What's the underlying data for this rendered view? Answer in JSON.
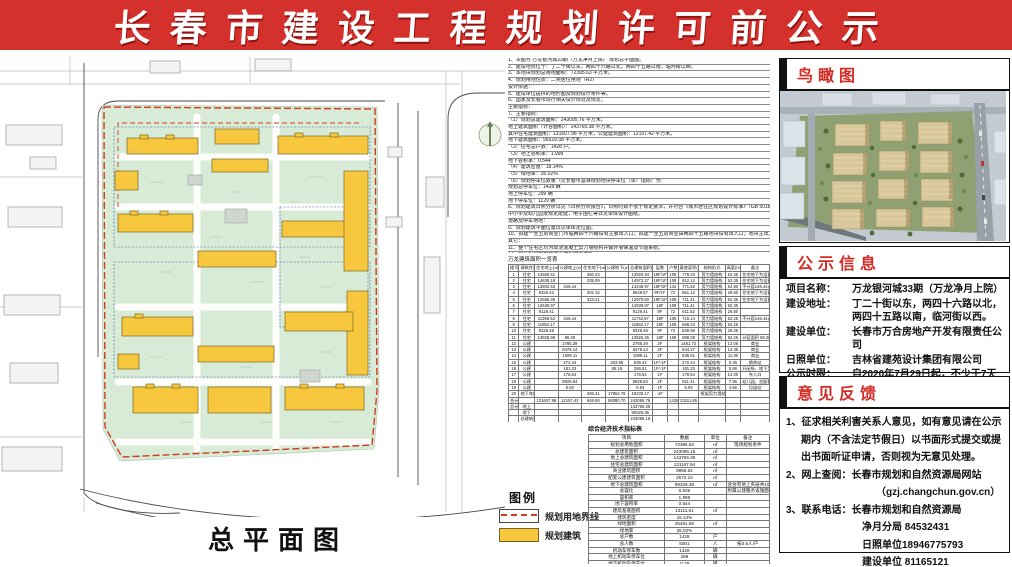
{
  "banner": {
    "title": "长春市建设工程规划许可前公示"
  },
  "site_plan": {
    "title": "总平面图",
    "legend": {
      "title": "图例",
      "items": [
        {
          "label": "规划用地界线",
          "swatch": "red-dashed-line"
        },
        {
          "label": "规划建筑",
          "swatch": "yellow-fill"
        }
      ]
    }
  },
  "notes": {
    "lines": [
      "1、本图为 万龙银河城33期（万龙净月上院） 规划总平面图。",
      "2、建设地点位于：丁二十街以东，两四十六路以北，两四十五路以南，临河街以西。",
      "3、本地块规划总用地面积：72395.63 平方米。",
      "4、规划用地性质：二类居住用地（R2）",
      "设计依据：",
      "5、建设单位提供的地形图及规划设计条件等。",
      "6、国家及长春市现行相关设计规范及规定。",
      "主要指标：",
      "7、主要指标：",
      "（1）规划总建筑面积：243095.76 平方米。",
      "地上建筑面积（计容面积）：143765.38 平方米。",
      "其中住宅建筑面积：131607.98 平方米，公建建筑面积：12157.42 平方米。",
      "地下建筑面积：99329.38 平方米。",
      "（2）住宅总户数：1428 户。",
      "（3）地上容积率：1.999",
      "地下容积率：0.544",
      "（4）建筑密度：18.14%",
      "（5）绿地率：35.02%",
      "（6）规划停车位数量（见长春市基准规划地块停车位（单）指标）为：",
      "规划总停车位：1428 辆",
      "地上停车位：299 辆",
      "地下停车位：1129 辆",
      "8、规划建筑日照分析详见《日照分析报告》，日照时数不低于规定要求，并符合《城市居住区规划设计标准》（GB 50180-2018）。",
      "中小学及幼儿园按规定配建，电子围栏等详见单体设计图纸。",
      "道路及停车场地：",
      "9、规划建筑平面位置详见单体定位图。",
      "10、拟建一至五层商业门市临两四十六路设有主要出入口；拟建一至五层商业由两四十五路地块设有出入口；地块主出入口临丁二十街设置。",
      "其它：",
      "11、整个住宅区均为现浇混凝土剪力墙结构并做外墙保温及节能系统。",
      "12、停车位应预留安装充电设施的条件。",
      "13、图中尺寸以毫米计，标高以米计，均为绝对标高。",
      "14、本项目各单体建筑间距、退线均满足规范要求。拟建高层与周边既有建筑日照间距满足《城市居住区规划设计标准》要求，不足部分已与相关利害关系人协商，日照分析详见报告，板式高层不大于13m，塔式高层不大于15m。",
      "15、西侧不满足退线要求的建筑已与相关权利人签订书面协议，见全套成果存档。",
      "16、其他未尽事宜按《工程建设标准强制性条文》及现行有关规范执行。"
    ]
  },
  "building_table": {
    "title": "万龙建筑面积一览表",
    "columns": [
      "楼号",
      "建筑性质",
      "住宅地上(㎡)",
      "公建地上(㎡)",
      "住宅地下(㎡)",
      "公建地下(㎡)",
      "总建筑面积(㎡)",
      "层数",
      "户数",
      "基底面积(㎡)",
      "结构形式",
      "高度(m)",
      "备注"
    ],
    "rows": [
      [
        "1",
        "住宅",
        "13560.51",
        "",
        "360.43",
        "",
        "13920.94",
        "18F/1F",
        "108",
        "778.33",
        "剪力墙结构",
        "52.35",
        "住宅地下为设备夹层"
      ],
      [
        "2",
        "住宅",
        "14638.18",
        "",
        "335.09",
        "",
        "14973.27",
        "18F/1F",
        "108",
        "812.12",
        "剪力墙结构",
        "52.35",
        "住宅地下为设备夹层"
      ],
      [
        "3",
        "住宅",
        "13902.53",
        "346.44",
        "",
        "",
        "14248.97",
        "18F/2F",
        "144",
        "771.52",
        "剪力墙结构",
        "54.90",
        "不计容146.44㎡"
      ],
      [
        "4",
        "住宅",
        "9326.42",
        "",
        "302.15",
        "",
        "9628.57",
        "9F/1F",
        "72",
        "861.12",
        "剪力墙结构",
        "28.60",
        "住宅地下为设备夹层"
      ],
      [
        "5",
        "住宅",
        "12656.39",
        "",
        "323.21",
        "",
        "12979.60",
        "18F/1F",
        "108",
        "711.41",
        "剪力墙结构",
        "52.35",
        "住宅地下为设备夹层"
      ],
      [
        "6",
        "住宅",
        "12639.97",
        "",
        "",
        "",
        "12639.97",
        "18F",
        "108",
        "711.41",
        "剪力墙结构",
        "52.35",
        ""
      ],
      [
        "7",
        "住宅",
        "9128.41",
        "",
        "",
        "",
        "9128.41",
        "9F",
        "72",
        "611.52",
        "剪力墙结构",
        "26.60",
        ""
      ],
      [
        "8",
        "住宅",
        "11396.53",
        "346.44",
        "",
        "",
        "11742.97",
        "18F",
        "108",
        "715.14",
        "剪力墙结构",
        "52.25",
        "不计容146.44㎡"
      ],
      [
        "9",
        "住宅",
        "11862.17",
        "",
        "",
        "",
        "11862.17",
        "18F",
        "108",
        "668.34",
        "剪力墙结构",
        "52.25",
        ""
      ],
      [
        "10",
        "住宅",
        "8328.49",
        "",
        "",
        "",
        "8328.49",
        "9F",
        "72",
        "628.98",
        "剪力墙结构",
        "26.25",
        ""
      ],
      [
        "11",
        "住宅",
        "13828.98",
        "96.28",
        "",
        "",
        "13925.26",
        "18F",
        "108",
        "888.08",
        "剪力墙结构",
        "52.25",
        "计容面积 96.28㎡"
      ],
      [
        "12",
        "公建",
        "",
        "2785.39",
        "",
        "",
        "2785.39",
        "2F",
        "",
        "1481.72",
        "框架结构",
        "13.06",
        "商业"
      ],
      [
        "13",
        "公建",
        "",
        "8478.14",
        "",
        "",
        "8478.14",
        "3F",
        "",
        "844.37",
        "框架结构",
        "13.35",
        "商业"
      ],
      [
        "14",
        "公建",
        "",
        "1089.11",
        "",
        "",
        "1089.11",
        "2F",
        "",
        "638.81",
        "框架结构",
        "11.36",
        "商业"
      ],
      [
        "15",
        "公建",
        "",
        "272.44",
        "",
        "263.98",
        "536.42",
        "1F/-1F",
        "",
        "272.44",
        "框架结构",
        "5.36",
        "换热站"
      ],
      [
        "16",
        "公建",
        "",
        "181.33",
        "",
        "85.18",
        "266.51",
        "1F/-1F",
        "",
        "181.33",
        "框架结构",
        "5.88",
        "开闭所，地下为设备用房"
      ],
      [
        "17",
        "公建",
        "",
        "178.54",
        "",
        "",
        "178.54",
        "1F",
        "",
        "178.54",
        "框架结构",
        "14.00",
        "东入口"
      ],
      [
        "18",
        "公建",
        "",
        "8928.84",
        "",
        "",
        "8928.84",
        "2F",
        "",
        "911.41",
        "框架结构",
        "7.95",
        "幼儿园，含配套用房994.04㎡"
      ],
      [
        "19",
        "公建",
        "",
        "5.93",
        "",
        "",
        "5.93",
        "1F",
        "",
        "5.93",
        "框架结构",
        "4.56",
        "垃圾站"
      ],
      [
        "20",
        "地下车库",
        "",
        "",
        "265.41",
        "17964.76",
        "18230.17",
        "-1F",
        "",
        "",
        "框架剪力墙结构",
        "",
        ""
      ],
      [
        "合计",
        "",
        "131607.98",
        "12157.42",
        "948.68",
        "98380.70",
        "243095.76",
        "",
        "1428",
        "23111.85",
        "",
        "",
        ""
      ],
      [
        "总计",
        "地上",
        "",
        "",
        "",
        "",
        "143765.38",
        "",
        "",
        "",
        "",
        "",
        ""
      ],
      [
        "",
        "地下",
        "",
        "",
        "",
        "",
        "99329.38",
        "",
        "",
        "",
        "",
        "",
        ""
      ],
      [
        "",
        "总建筑面积",
        "",
        "",
        "",
        "",
        "243095.16",
        "",
        "",
        "",
        "",
        "",
        ""
      ]
    ]
  },
  "indicator_table": {
    "title": "综合经济技术指标表",
    "columns": [
      "项目",
      "数据",
      "单位",
      "备注"
    ],
    "rows": [
      [
        "规划总用地面积",
        "72395.63",
        "㎡",
        "现场规划条件"
      ],
      [
        "总建筑面积",
        "243095.16",
        "㎡",
        ""
      ],
      [
        "地上总建筑面积",
        "143765.38",
        "㎡",
        ""
      ],
      [
        "住宅总建筑面积",
        "131167.94",
        "㎡",
        ""
      ],
      [
        "商业建筑面积",
        "9956.64",
        "㎡",
        ""
      ],
      [
        "配套公建建筑面积",
        "2572.10",
        "㎡",
        ""
      ],
      [
        "地下总建筑面积",
        "99329.38",
        "㎡",
        "含住宅地上夹层共1049.09㎡"
      ],
      [
        "总容比",
        "6.939",
        "",
        "附属公建服务设施面积占地上总建筑面积"
      ],
      [
        "容积率",
        "1.999",
        "",
        ""
      ],
      [
        "地下容积率",
        "0.544",
        "",
        ""
      ],
      [
        "建筑基底面积",
        "13111.61",
        "㎡",
        ""
      ],
      [
        "建筑密度",
        "18.14%",
        "",
        ""
      ],
      [
        "绿地面积",
        "25491.59",
        "㎡",
        ""
      ],
      [
        "绿地率",
        "35.02%",
        "",
        ""
      ],
      [
        "总户数",
        "1428",
        "户",
        ""
      ],
      [
        "总人数",
        "5001",
        "人",
        "按3.5人/户"
      ],
      [
        "机动车停车数",
        "1428",
        "辆",
        ""
      ],
      [
        "地上机动车停车位",
        "299",
        "辆",
        ""
      ],
      [
        "地下机动车停车位",
        "1129",
        "辆",
        ""
      ],
      [
        "非机动车停车数",
        "2277",
        "辆",
        ""
      ]
    ]
  },
  "panels": {
    "aerial": {
      "title": "鸟瞰图"
    },
    "notice": {
      "title": "公示信息",
      "fields": [
        {
          "label": "项目名称：",
          "value": "万龙银河城33期（万龙净月上院）"
        },
        {
          "label": "建设地址：",
          "value": "丁二十街以东，两四十六路以北，两四十五路以南，临河街以西。"
        },
        {
          "label": "建设单位：",
          "value": "长春市万合房地产开发有限责任公司"
        },
        {
          "label": "日照单位：",
          "value": "吉林省建苑设计集团有限公司"
        },
        {
          "label": "公示时限：",
          "value": "自2020年7月29日起，不少于7天"
        }
      ]
    },
    "feedback": {
      "title": "意见反馈",
      "lines": [
        {
          "t": "1、征求相关利害关系人意见，如有意见请在公示期内（不含法定节假日）以书面形式提交或提出书面听证申请，否则视为无意见处理。",
          "i": 0
        },
        {
          "t": "2、网上查阅：长春市规划和自然资源局网站",
          "i": 0
        },
        {
          "t": "（gzj.changchun.gov.cn）",
          "i": 2
        },
        {
          "t": "3、联系电话：长春市规划和自然资源局",
          "i": 0
        },
        {
          "t": "净月分局 84532431",
          "i": 1
        },
        {
          "t": "日照单位18946775793",
          "i": 1
        },
        {
          "t": "建设单位 81165121",
          "i": 1
        }
      ]
    }
  },
  "colors": {
    "banner_red": "#d4302c",
    "section_title_red": "#d42a24",
    "site_green": "#d8ebd6",
    "building_yellow": "#f7c83d",
    "boundary_red": "#d03a20"
  }
}
